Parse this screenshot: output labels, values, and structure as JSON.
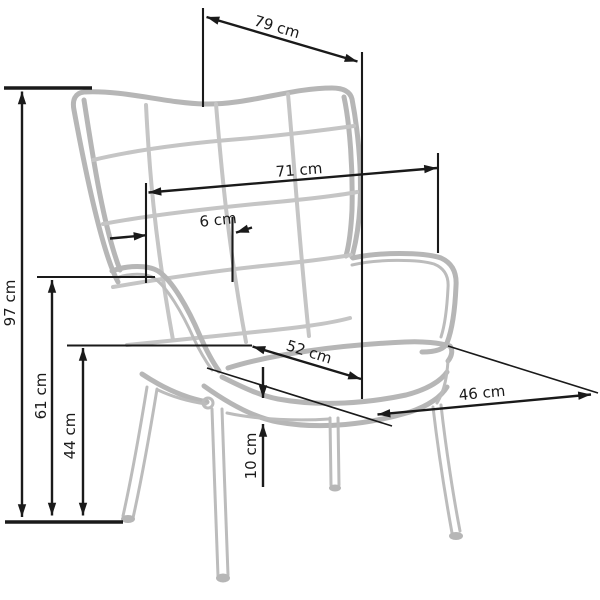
{
  "diagram": {
    "type": "furniture-dimension-diagram",
    "subject": "wingback tufted armchair, three-quarter view line drawing",
    "unit": "cm",
    "colors": {
      "background": "#ffffff",
      "chair_outline": "#b6b6b6",
      "chair_seams": "#c5c5c5",
      "dimension_lines": "#1a1a1a"
    },
    "dimensions": [
      {
        "name": "total_depth",
        "value": 79,
        "label": "79 cm"
      },
      {
        "name": "back_width",
        "value": 71,
        "label": "71 cm"
      },
      {
        "name": "wing_offset",
        "value": 6,
        "label": "6 cm"
      },
      {
        "name": "total_height",
        "value": 97,
        "label": "97 cm"
      },
      {
        "name": "armrest_height",
        "value": 61,
        "label": "61 cm"
      },
      {
        "name": "seat_height",
        "value": 44,
        "label": "44 cm"
      },
      {
        "name": "seat_depth",
        "value": 52,
        "label": "52 cm"
      },
      {
        "name": "seat_width",
        "value": 46,
        "label": "46 cm"
      },
      {
        "name": "cushion_thickness",
        "value": 10,
        "label": "10 cm"
      }
    ]
  }
}
